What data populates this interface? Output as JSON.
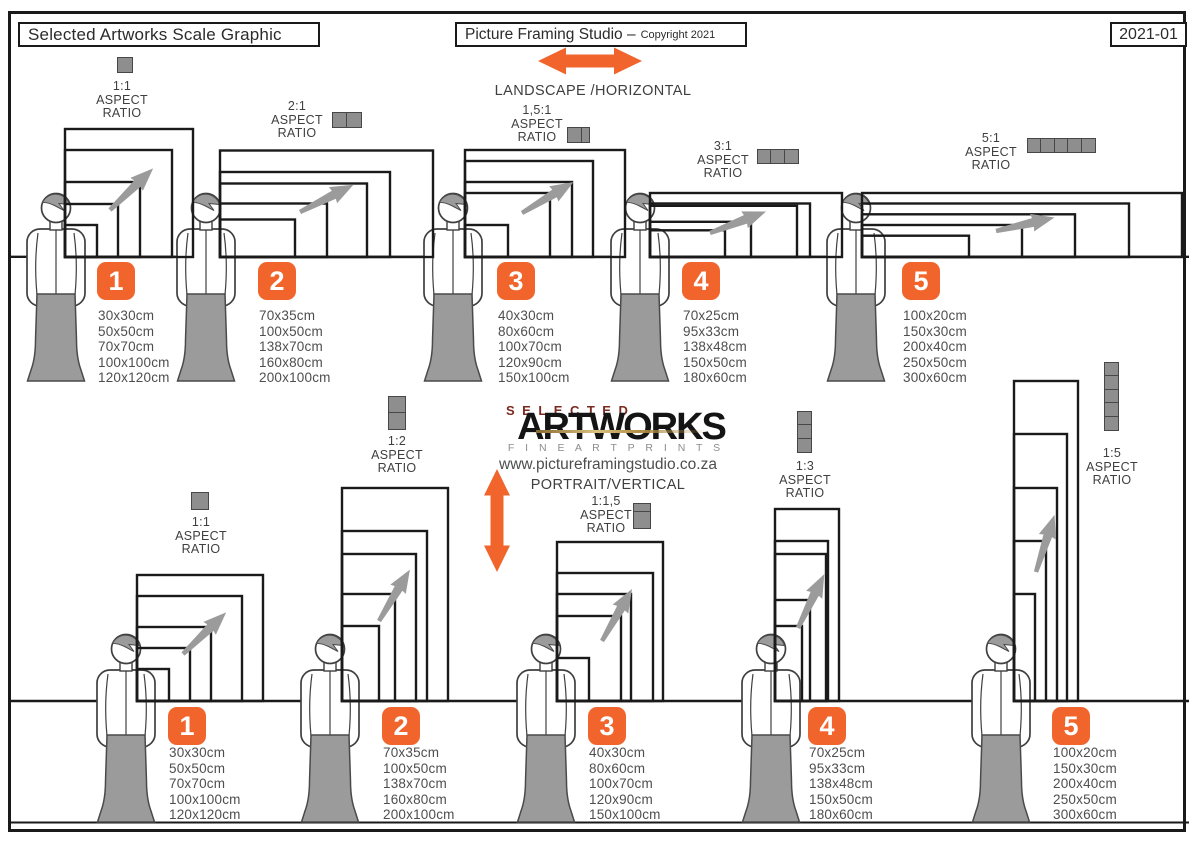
{
  "header": {
    "left_title": "Selected Artworks Scale Graphic",
    "center_title": "Picture Framing Studio –",
    "center_subtitle": "Copyright 2021",
    "right_title": "2021-01"
  },
  "labels": {
    "aspect": "ASPECT",
    "ratio": "RATIO"
  },
  "directions": {
    "landscape": "LANDSCAPE /HORIZONTAL",
    "portrait": "PORTRAIT/VERTICAL"
  },
  "logo": {
    "top": "SELECTED",
    "name": "ARTWORKS",
    "tagline": "F I N E   A R T   P R I N T S",
    "website": "www.pictureframingstudio.co.za"
  },
  "landscape_groups": [
    {
      "number": "1",
      "ratio": "1:1",
      "sizes": [
        "30x30cm",
        "50x50cm",
        "70x70cm",
        "100x100cm",
        "120x120cm"
      ]
    },
    {
      "number": "2",
      "ratio": "2:1",
      "sizes": [
        "70x35cm",
        "100x50cm",
        "138x70cm",
        "160x80cm",
        "200x100cm"
      ]
    },
    {
      "number": "3",
      "ratio": "1,5:1",
      "sizes": [
        "40x30cm",
        "80x60cm",
        "100x70cm",
        "120x90cm",
        "150x100cm"
      ]
    },
    {
      "number": "4",
      "ratio": "3:1",
      "sizes": [
        "70x25cm",
        "95x33cm",
        "138x48cm",
        "150x50cm",
        "180x60cm"
      ]
    },
    {
      "number": "5",
      "ratio": "5:1",
      "sizes": [
        "100x20cm",
        "150x30cm",
        "200x40cm",
        "250x50cm",
        "300x60cm"
      ]
    }
  ],
  "portrait_groups": [
    {
      "number": "1",
      "ratio": "1:1",
      "sizes": [
        "30x30cm",
        "50x50cm",
        "70x70cm",
        "100x100cm",
        "120x120cm"
      ]
    },
    {
      "number": "2",
      "ratio": "1:2",
      "sizes": [
        "70x35cm",
        "100x50cm",
        "138x70cm",
        "160x80cm",
        "200x100cm"
      ]
    },
    {
      "number": "3",
      "ratio": "1:1,5",
      "sizes": [
        "40x30cm",
        "80x60cm",
        "100x70cm",
        "120x90cm",
        "150x100cm"
      ]
    },
    {
      "number": "4",
      "ratio": "1:3",
      "sizes": [
        "70x25cm",
        "95x33cm",
        "138x48cm",
        "150x50cm",
        "180x60cm"
      ]
    },
    {
      "number": "5",
      "ratio": "1:5",
      "sizes": [
        "100x20cm",
        "150x30cm",
        "200x40cm",
        "250x50cm",
        "300x60cm"
      ]
    }
  ],
  "colors": {
    "accent_orange": "#F1642C",
    "figure_gray": "#9B9B9B",
    "icon_gray": "#8E8E8E",
    "line_dark": "#1A1A1A",
    "text_dark": "#4E4E4E",
    "logo_maroon": "#7B2A22"
  }
}
